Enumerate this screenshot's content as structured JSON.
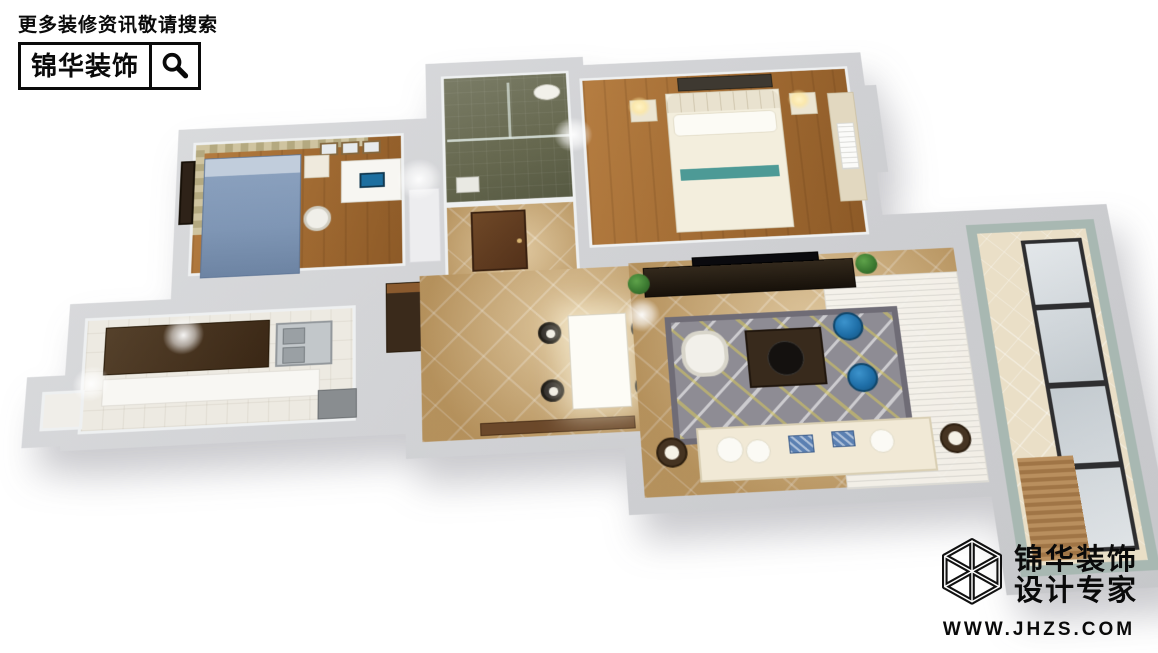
{
  "header": {
    "search_hint": "更多装修资讯敬请搜索",
    "brand_name": "锦华装饰",
    "icon": "magnifier-icon"
  },
  "footer": {
    "brand_line1": "锦华装饰",
    "brand_line2": "设计专家",
    "website": "WWW.JHZS.COM",
    "icon": "cube-wireframe-logo"
  },
  "floorplan": {
    "view": "3d-birdseye-render",
    "rooms": [
      "study",
      "bathroom",
      "hallway",
      "master-bedroom",
      "kitchen",
      "utility",
      "dining",
      "living",
      "balcony"
    ],
    "colors": {
      "wall": "#d2d4d7",
      "wood_floor": "#a06a32",
      "tile_floor": "#c8a56e",
      "bathroom_floor": "#66684f",
      "balcony_tile": "#eadfc7",
      "balcony_border_tile": "#a8b8b2",
      "study_bed_blue": "#7f96b5",
      "curtain_khaki": "#c0b48c",
      "rug_gray": "#8e8c94",
      "rug_accent_yellow": "#d5c75c",
      "stool_blue": "#1f6fa8",
      "sofa_cream": "#f1e9d6",
      "cabinet_dark_wood": "#3a2715",
      "branding_black": "#0a0a0a"
    }
  }
}
